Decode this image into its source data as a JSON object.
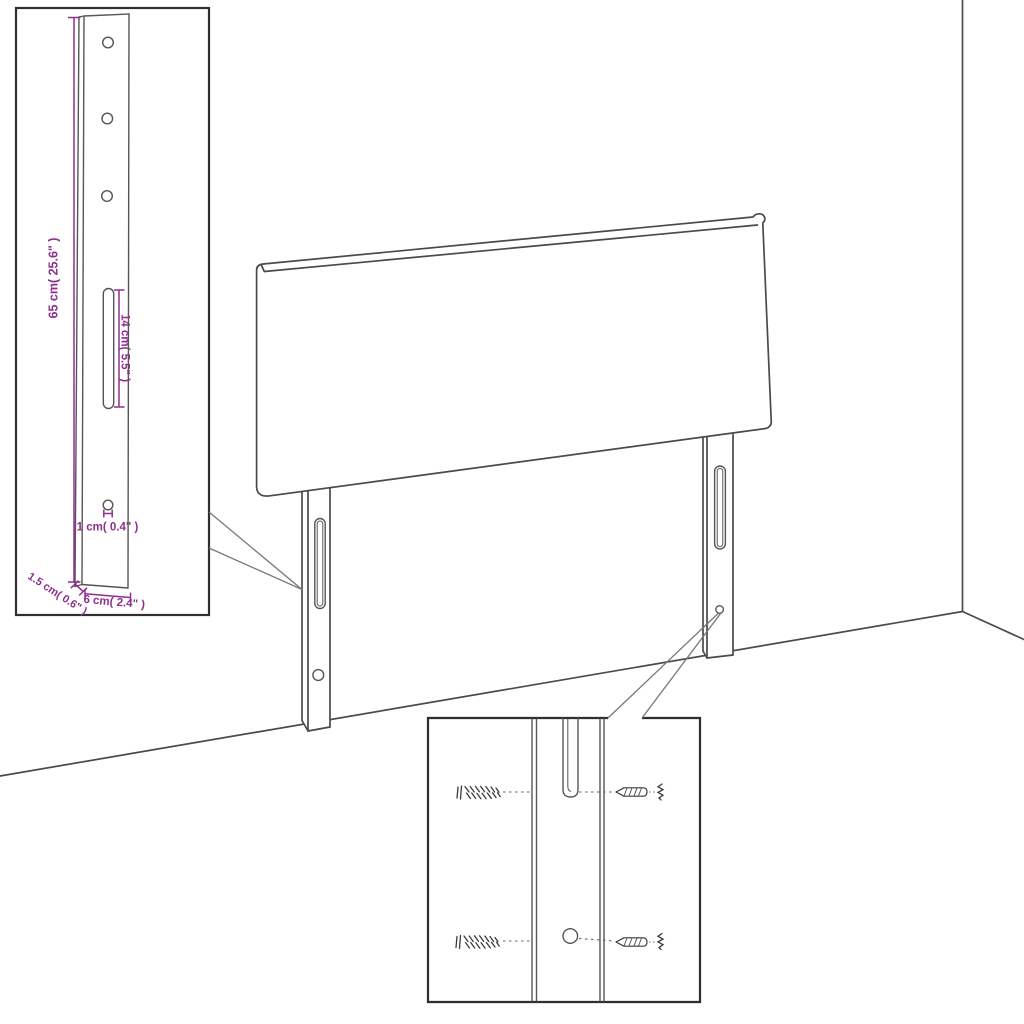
{
  "diagram": {
    "kind": "headboard-assembly-diagram",
    "colors": {
      "annotation": "#8e2f8e",
      "line": "#4a4a4a",
      "background": "#ffffff"
    },
    "dimensions": {
      "bracket_height": "65 cm( 25.6\" )",
      "slot_length": "14 cm( 5.5\" )",
      "hole_diameter": "1 cm( 0.4\" )",
      "bracket_depth": "1.5 cm( 0.6\" )",
      "bracket_width": "6 cm( 2.4\" )"
    }
  }
}
